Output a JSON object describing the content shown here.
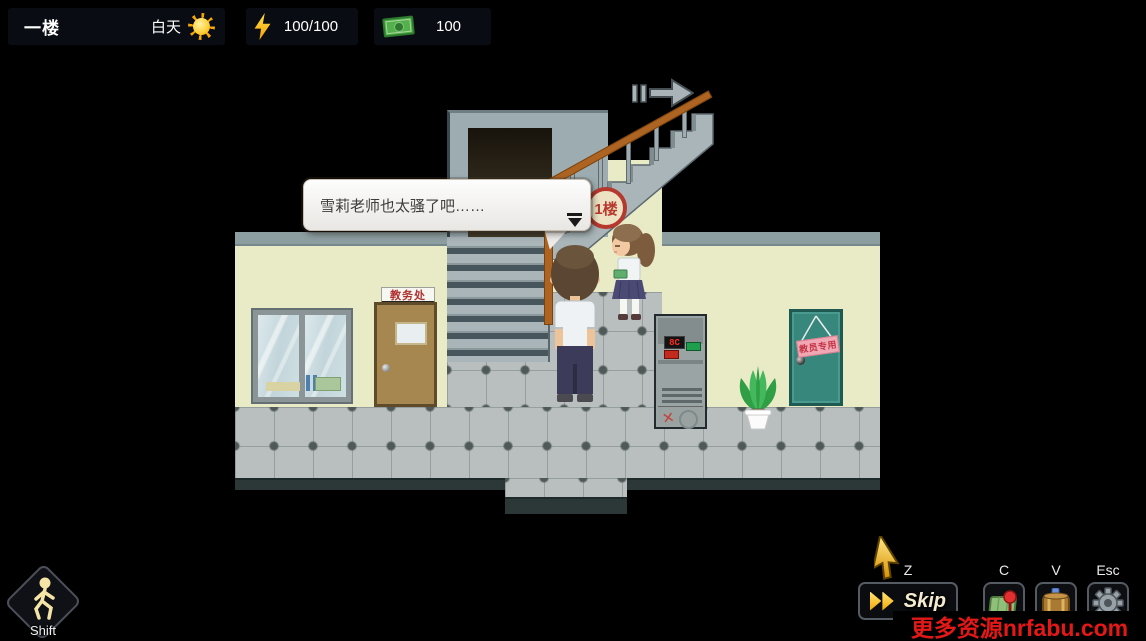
{
  "hud": {
    "floor_label": "一楼",
    "time_label": "白天",
    "energy_value": "100/100",
    "money_value": "100"
  },
  "dialogue": {
    "text": "雪莉老师也太骚了吧……"
  },
  "scene": {
    "floor_sign": "1楼",
    "office_sign": "教务处",
    "teacher_sign": "教员专用",
    "vending_display": "8C",
    "vending_x_mark": "✕"
  },
  "controls": {
    "shift_key": "Shift",
    "skip_key": "Z",
    "skip_label": "Skip",
    "map_key": "C",
    "items_key": "V",
    "settings_key": "Esc"
  },
  "watermark": {
    "text": "更多资源nrfabu.com"
  },
  "colors": {
    "wall": "#e9ebc6",
    "floor": "#b9bebe",
    "handrail": "#ad6322",
    "teacher_door": "#37877d",
    "office_door": "#a6874f",
    "watermark_red": "#e51818"
  }
}
